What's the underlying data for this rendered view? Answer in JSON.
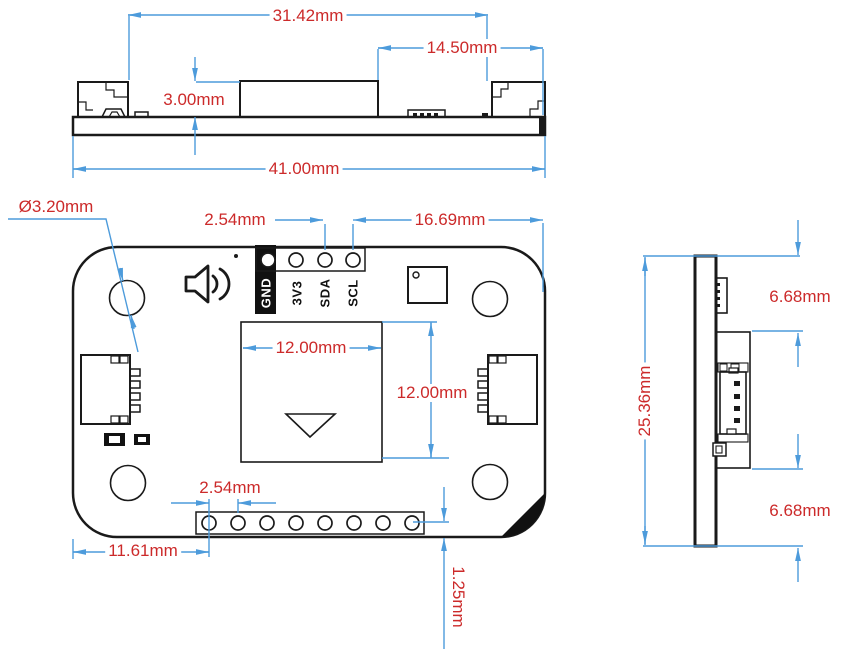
{
  "title": "PCB module dimensional drawing",
  "colors": {
    "line": "#1a1a1a",
    "dimension_line": "#4d9bdb",
    "dimension_text": "#cc2a2a"
  },
  "views": {
    "top": {
      "label": "top-profile-view",
      "dims": {
        "inner_width": "31.42mm",
        "right_width": "14.50mm",
        "component_height": "3.00mm",
        "total_width": "41.00mm"
      }
    },
    "front": {
      "label": "front-pcb-view",
      "pin_labels": [
        "GND",
        "3V3",
        "SDA",
        "SCL"
      ],
      "dims": {
        "hole_diameter": "Ø3.20mm",
        "top_pin_pitch": "2.54mm",
        "pin_to_edge": "16.69mm",
        "sensor_width": "12.00mm",
        "sensor_height": "12.00mm",
        "bottom_pin_pitch": "2.54mm",
        "edge_to_first_pin": "11.61mm",
        "row_to_edge": "1.25mm"
      }
    },
    "side": {
      "label": "side-profile-view",
      "dims": {
        "upper_offset": "6.68mm",
        "board_height": "25.36mm",
        "lower_offset": "6.68mm"
      }
    }
  }
}
